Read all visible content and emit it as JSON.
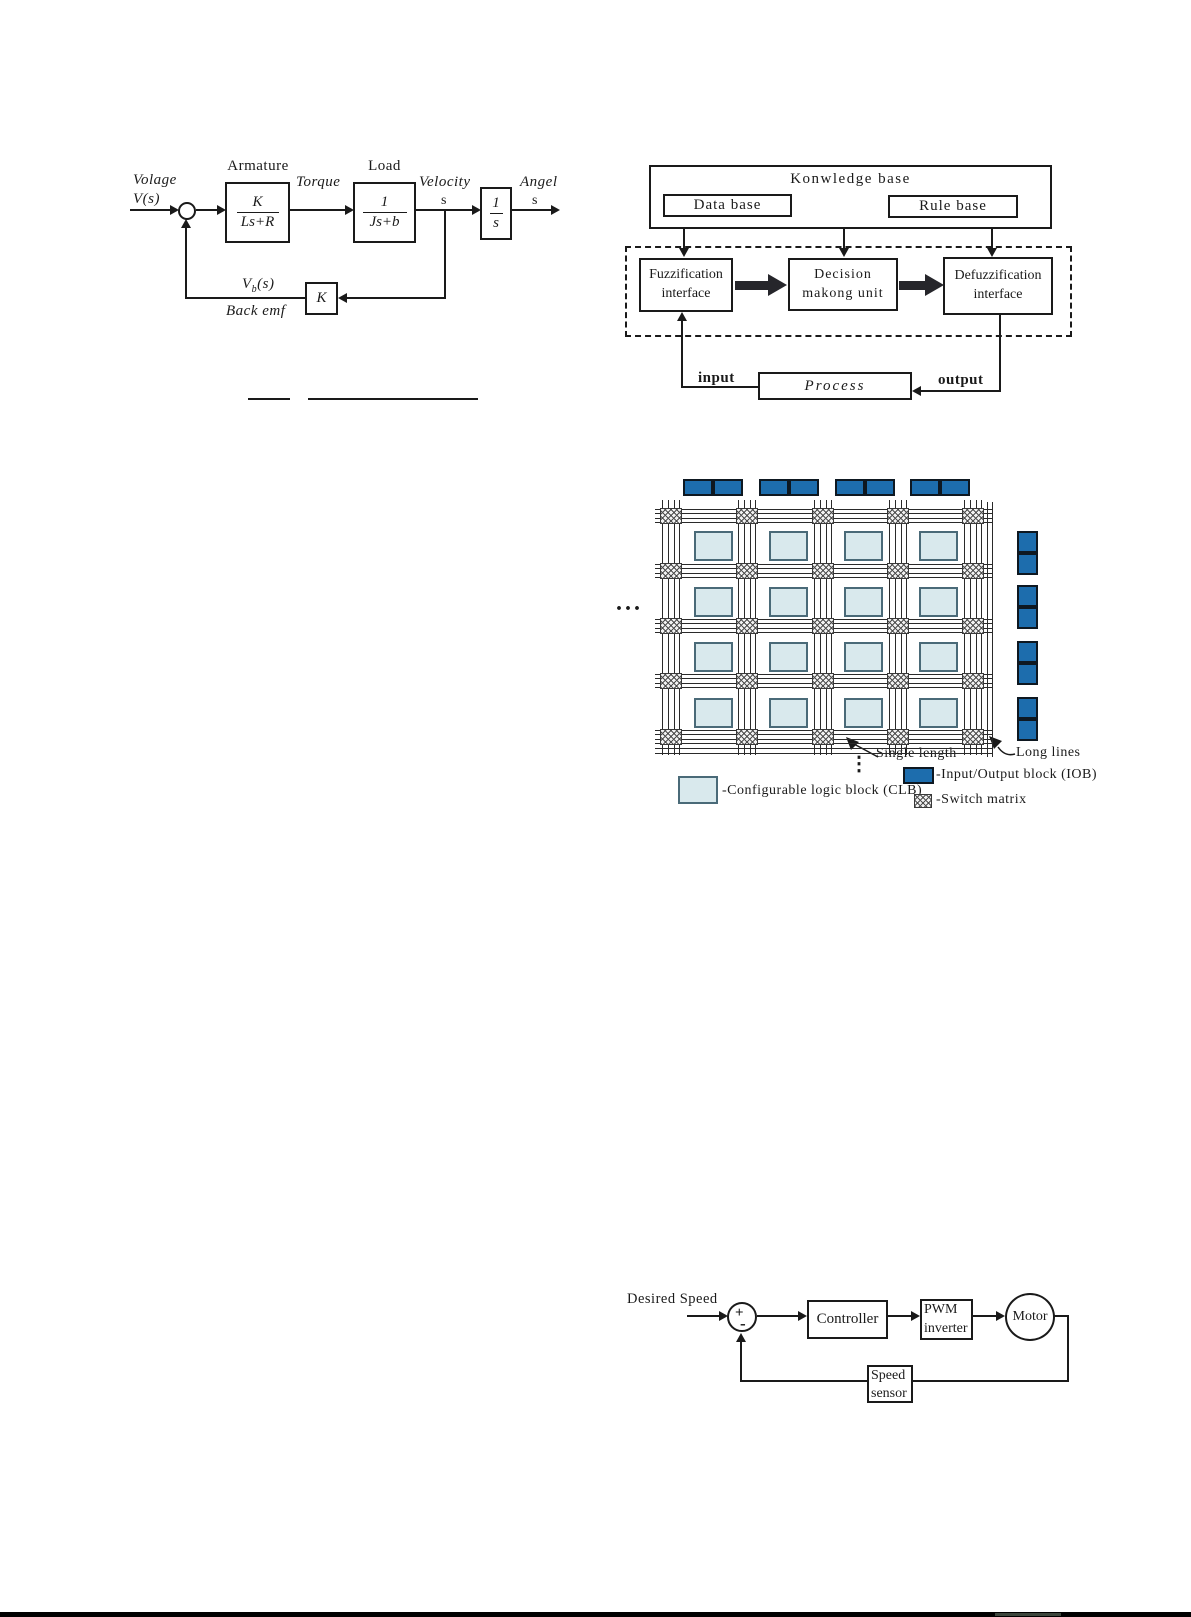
{
  "motor_diagram": {
    "input_label_line1": "Volage",
    "input_label_line2": "V(s)",
    "armature_label": "Armature",
    "armature_num": "K",
    "armature_den": "Ls+R",
    "torque_label": "Torque",
    "load_label": "Load",
    "load_num": "1",
    "load_den": "Js+b",
    "velocity_label": "Velocity",
    "velocity_s": "s",
    "integrator_num": "1",
    "integrator_den": "s",
    "angle_label": "Angel",
    "angle_s": "s",
    "feedback_gain": "K",
    "feedback_signal_main": "V",
    "feedback_signal_sub": "b",
    "feedback_signal_rest": "(s)",
    "feedback_label": "Back emf"
  },
  "fuzzy_diagram": {
    "knowledge_base": "Konwledge base",
    "data_base": "Data base",
    "rule_base": "Rule base",
    "fuzzification_line1": "Fuzzification",
    "fuzzification_line2": "interface",
    "decision_line1": "Decision",
    "decision_line2": "makong unit",
    "defuzzification_line1": "Defuzzification",
    "defuzzification_line2": "interface",
    "process": "Process",
    "input_label": "input",
    "output_label": "output"
  },
  "fpga_diagram": {
    "ellipsis_horizontal": "...",
    "ellipsis_vertical": "⋮",
    "single_length_label": "Single length",
    "long_lines_label": "Long lines",
    "legend": {
      "clb": "-Configurable logic block (CLB)",
      "iob": "-Input/Output block (IOB)",
      "switch": "-Switch matrix"
    },
    "colors": {
      "iob_fill": "#1d6dad",
      "iob_border": "#0e1821",
      "clb_fill": "#d9e9ed",
      "clb_border": "#4a6a78"
    }
  },
  "speed_diagram": {
    "desired_speed": "Desired Speed",
    "plus": "+",
    "minus": "-",
    "controller": "Controller",
    "pwm_line1": "PWM",
    "pwm_line2": "inverter",
    "motor": "Motor",
    "sensor_line1": "Speed",
    "sensor_line2": "sensor"
  }
}
